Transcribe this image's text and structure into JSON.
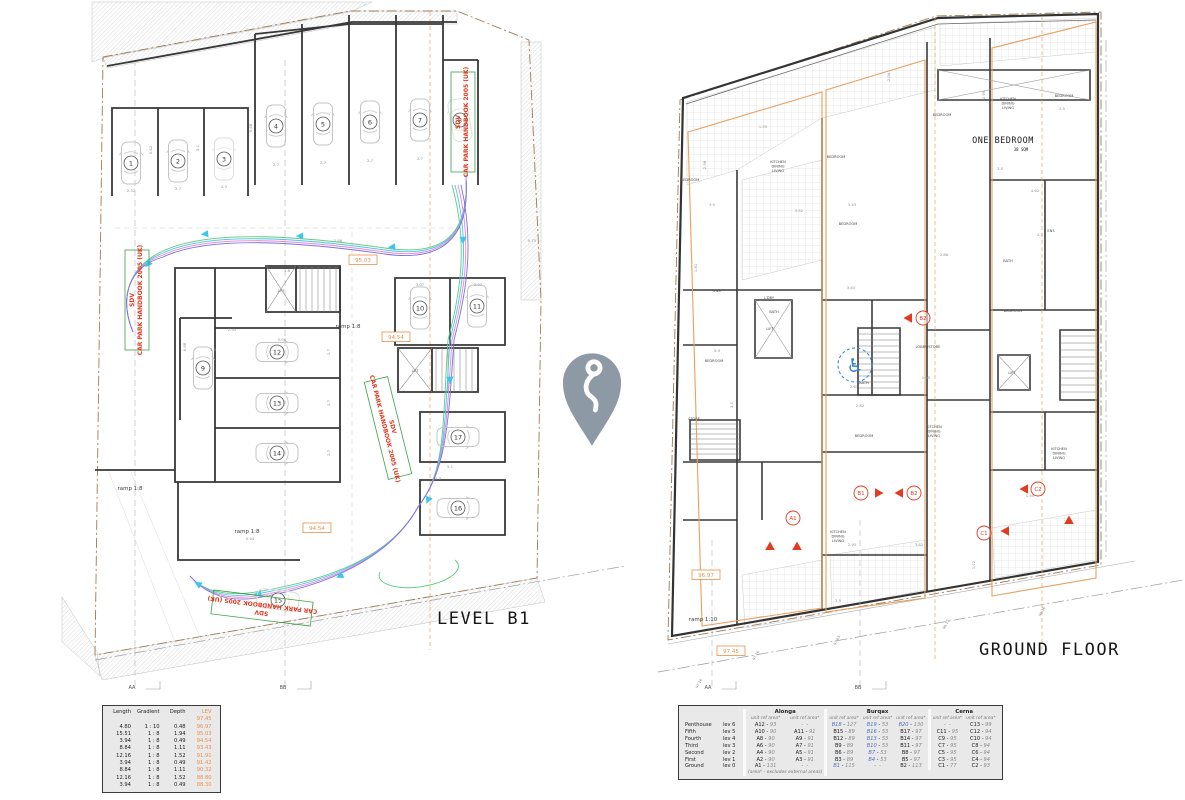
{
  "colors": {
    "red": "#e23b22",
    "orange": "#e8914c",
    "orange_line": "#e8a060",
    "boundary": "#9c7a55",
    "blue_ref": "#4a73c0",
    "wheelchair_blue": "#2b7fd4",
    "pin": "#8d9aa6",
    "swept": [
      "#62c97f",
      "#45c7e8",
      "#ee82d8",
      "#7a72e0"
    ],
    "arrow": "#3ec7ea",
    "green_box": "#3da04a"
  },
  "center_marker": {
    "icon": "location-pin"
  },
  "left_plan": {
    "title": "LEVEL B1",
    "section_markers": [
      {
        "label": "AA",
        "x": 132,
        "y": 689
      },
      {
        "label": "BB",
        "x": 283,
        "y": 689
      }
    ],
    "sdv_labels": [
      {
        "line1": "SDV",
        "line2": "CAR PARK HANDBOOK 2005 (UK)",
        "x": 463,
        "y": 122,
        "rot": -90
      },
      {
        "line1": "SDV",
        "line2": "CAR PARK HANDBOOK 2005 (UK)",
        "x": 137,
        "y": 300,
        "rot": -90
      },
      {
        "line1": "SDV",
        "line2": "CAR PARK HANDBOOK 2005 (UK)",
        "x": 388,
        "y": 428,
        "rot": 76
      },
      {
        "line1": "SDV",
        "line2": "CAR PARK HANDBOOK 2005 (UK)",
        "x": 262,
        "y": 608,
        "rot": 187
      }
    ],
    "ramp_labels": [
      {
        "text": "ramp 1:8",
        "x": 348,
        "y": 328
      },
      {
        "text": "ramp 1:8",
        "x": 247,
        "y": 533
      },
      {
        "text": "ramp 1:8",
        "x": 130,
        "y": 490
      }
    ],
    "spot_levels": [
      {
        "text": "95.03",
        "x": 363,
        "y": 262
      },
      {
        "text": "94.54",
        "x": 396,
        "y": 339
      },
      {
        "text": "94.54",
        "x": 317,
        "y": 530
      }
    ],
    "lift_label": "LIFT",
    "bays": [
      {
        "n": "1",
        "x": 131,
        "y": 163,
        "rot": 0
      },
      {
        "n": "2",
        "x": 178,
        "y": 161,
        "rot": 0
      },
      {
        "n": "3",
        "x": 224,
        "y": 159,
        "rot": 0,
        "faint": true
      },
      {
        "n": "4",
        "x": 276,
        "y": 126,
        "rot": 0
      },
      {
        "n": "5",
        "x": 323,
        "y": 124,
        "rot": 0
      },
      {
        "n": "6",
        "x": 370,
        "y": 122,
        "rot": 0
      },
      {
        "n": "7",
        "x": 420,
        "y": 120,
        "rot": 0
      },
      {
        "n": "8",
        "x": 460,
        "y": 120,
        "rot": -10,
        "faint": true
      },
      {
        "n": "9",
        "x": 203,
        "y": 368,
        "rot": 0
      },
      {
        "n": "10",
        "x": 420,
        "y": 308,
        "rot": 0
      },
      {
        "n": "11",
        "x": 477,
        "y": 306,
        "rot": 0
      },
      {
        "n": "12",
        "x": 277,
        "y": 352,
        "rot": 90
      },
      {
        "n": "13",
        "x": 277,
        "y": 403,
        "rot": 90
      },
      {
        "n": "14",
        "x": 277,
        "y": 453,
        "rot": 90
      },
      {
        "n": "15",
        "x": 278,
        "y": 600,
        "rot": 97,
        "faint": true
      },
      {
        "n": "16",
        "x": 458,
        "y": 508,
        "rot": 90
      },
      {
        "n": "17",
        "x": 458,
        "y": 437,
        "rot": 90
      }
    ],
    "dims": [
      {
        "t": "2.32",
        "x": 131,
        "y": 192
      },
      {
        "t": "2.7",
        "x": 178,
        "y": 190
      },
      {
        "t": "2.3",
        "x": 224,
        "y": 188
      },
      {
        "t": "2.7",
        "x": 276,
        "y": 166
      },
      {
        "t": "2.7",
        "x": 323,
        "y": 164
      },
      {
        "t": "2.7",
        "x": 370,
        "y": 162
      },
      {
        "t": "2.7",
        "x": 420,
        "y": 160
      },
      {
        "t": "5.42",
        "x": 152,
        "y": 150,
        "r": -90
      },
      {
        "t": "5.1",
        "x": 199,
        "y": 148,
        "r": -90
      },
      {
        "t": "5.68",
        "x": 252,
        "y": 128,
        "r": -90
      },
      {
        "t": "2.86",
        "x": 338,
        "y": 242
      },
      {
        "t": "2.93",
        "x": 232,
        "y": 331
      },
      {
        "t": "5.06",
        "x": 282,
        "y": 341
      },
      {
        "t": "6.88",
        "x": 186,
        "y": 347,
        "r": -90
      },
      {
        "t": "3.07",
        "x": 420,
        "y": 286
      },
      {
        "t": "3.07",
        "x": 478,
        "y": 286
      },
      {
        "t": "2.7",
        "x": 330,
        "y": 352,
        "r": -90
      },
      {
        "t": "2.7",
        "x": 330,
        "y": 403,
        "r": -90
      },
      {
        "t": "2.7",
        "x": 330,
        "y": 453,
        "r": -90
      },
      {
        "t": "5.3",
        "x": 438,
        "y": 480
      },
      {
        "t": "5.1",
        "x": 450,
        "y": 468
      },
      {
        "t": "1.6",
        "x": 287,
        "y": 272
      },
      {
        "t": "0.94",
        "x": 250,
        "y": 540
      },
      {
        "t": "5.9",
        "x": 213,
        "y": 351
      },
      {
        "t": "0.75",
        "x": 532,
        "y": 242
      }
    ]
  },
  "right_plan": {
    "title": "GROUND FLOOR",
    "section_markers": [
      {
        "label": "AA",
        "x": 708,
        "y": 689
      },
      {
        "label": "BB",
        "x": 858,
        "y": 689
      }
    ],
    "ramp_labels": [
      {
        "text": "ramp 1:10",
        "x": 703,
        "y": 621
      }
    ],
    "spot_levels": [
      {
        "text": "96.97",
        "x": 706,
        "y": 577
      },
      {
        "text": "97.45",
        "x": 731,
        "y": 653
      }
    ],
    "street_levels": [
      {
        "text": "97.16",
        "x": 700,
        "y": 684
      },
      {
        "text": "97.16",
        "x": 757,
        "y": 656
      },
      {
        "text": "97.63",
        "x": 838,
        "y": 641
      },
      {
        "text": "98.15",
        "x": 947,
        "y": 625
      },
      {
        "text": "98.36",
        "x": 1043,
        "y": 612
      }
    ],
    "one_bedroom": {
      "label": "ONE BEDROOM",
      "area": "38 SQM",
      "x": 1003,
      "y": 143
    },
    "unit_markers": [
      {
        "label": "A1",
        "x": 793,
        "y": 518
      },
      {
        "label": "B1",
        "x": 861,
        "y": 493
      },
      {
        "label": "B2",
        "x": 914,
        "y": 493
      },
      {
        "label": "B2",
        "x": 923,
        "y": 318
      },
      {
        "label": "C1",
        "x": 984,
        "y": 533
      },
      {
        "label": "C2",
        "x": 1038,
        "y": 489
      }
    ],
    "entry_arrows": [
      {
        "x": 770,
        "y": 546,
        "r": 0
      },
      {
        "x": 797,
        "y": 546,
        "r": 0
      },
      {
        "x": 879,
        "y": 493,
        "r": 90
      },
      {
        "x": 899,
        "y": 493,
        "r": -90
      },
      {
        "x": 908,
        "y": 318,
        "r": -90
      },
      {
        "x": 1005,
        "y": 531,
        "r": -90
      },
      {
        "x": 1024,
        "y": 489,
        "r": -90
      },
      {
        "x": 1069,
        "y": 520,
        "r": 0
      }
    ],
    "rooms": [
      {
        "t": "BEDROOM",
        "x": 690,
        "y": 181
      },
      {
        "t": "KITCHEN|DINING|LIVING",
        "x": 778,
        "y": 163
      },
      {
        "t": "BEDROOM",
        "x": 836,
        "y": 158
      },
      {
        "t": "BEDROOM",
        "x": 942,
        "y": 116
      },
      {
        "t": "KITCHEN|DINING|LIVING",
        "x": 1008,
        "y": 100
      },
      {
        "t": "BEDROOM",
        "x": 1064,
        "y": 97
      },
      {
        "t": "BEDROOM",
        "x": 848,
        "y": 225
      },
      {
        "t": "BEDROOM",
        "x": 1013,
        "y": 312
      },
      {
        "t": "BEDROOM",
        "x": 714,
        "y": 362
      },
      {
        "t": "BEDROOM",
        "x": 864,
        "y": 437
      },
      {
        "t": "LOBBY/STORE",
        "x": 928,
        "y": 348
      },
      {
        "t": "KITCHEN|DINING|LIVING",
        "x": 934,
        "y": 428
      },
      {
        "t": "LIFT",
        "x": 1012,
        "y": 374
      },
      {
        "t": "STORE",
        "x": 694,
        "y": 420
      },
      {
        "t": "BATH",
        "x": 774,
        "y": 313
      },
      {
        "t": "L'DRY",
        "x": 769,
        "y": 299
      },
      {
        "t": "ENS",
        "x": 717,
        "y": 292
      },
      {
        "t": "KITCHEN|DINING|LIVING",
        "x": 1059,
        "y": 450
      },
      {
        "t": "KITCHEN|DINING|LIVING",
        "x": 838,
        "y": 533
      },
      {
        "t": "BATH",
        "x": 1008,
        "y": 262
      },
      {
        "t": "BATH",
        "x": 864,
        "y": 384
      },
      {
        "t": "ENS",
        "x": 1051,
        "y": 232
      },
      {
        "t": "LIFT",
        "x": 770,
        "y": 330
      }
    ],
    "dims": [
      {
        "t": "3.5",
        "x": 712,
        "y": 206
      },
      {
        "t": "3.52",
        "x": 799,
        "y": 212
      },
      {
        "t": "3.43",
        "x": 851,
        "y": 289
      },
      {
        "t": "3.43",
        "x": 852,
        "y": 206
      },
      {
        "t": "2.86",
        "x": 944,
        "y": 256
      },
      {
        "t": "3.5",
        "x": 1000,
        "y": 170
      },
      {
        "t": "3.5",
        "x": 1062,
        "y": 110
      },
      {
        "t": "2.3",
        "x": 1040,
        "y": 236
      },
      {
        "t": "4.62",
        "x": 1035,
        "y": 192
      },
      {
        "t": "2.82",
        "x": 860,
        "y": 407
      },
      {
        "t": "2.67",
        "x": 854,
        "y": 388
      },
      {
        "t": "1.95",
        "x": 926,
        "y": 379
      },
      {
        "t": "3.82",
        "x": 919,
        "y": 546
      },
      {
        "t": "2.95",
        "x": 852,
        "y": 546
      },
      {
        "t": "1.55",
        "x": 1030,
        "y": 497
      },
      {
        "t": "2.95",
        "x": 985,
        "y": 95,
        "r": -90
      },
      {
        "t": "2.04",
        "x": 890,
        "y": 77,
        "r": -90
      },
      {
        "t": "1.81",
        "x": 697,
        "y": 268,
        "r": -90
      },
      {
        "t": "5.9",
        "x": 717,
        "y": 352
      },
      {
        "t": "3.1",
        "x": 733,
        "y": 405,
        "r": -90
      },
      {
        "t": "1.55",
        "x": 763,
        "y": 128
      },
      {
        "t": "2.98",
        "x": 706,
        "y": 165,
        "r": -90
      },
      {
        "t": "3.5",
        "x": 838,
        "y": 602
      },
      {
        "t": "1.72",
        "x": 975,
        "y": 565,
        "r": -90
      }
    ],
    "accessible_icon": "wheelchair-symbol"
  },
  "ramp_table": {
    "headers": [
      "Length",
      "Gradient",
      "Depth",
      "LEV"
    ],
    "rows": [
      [
        "",
        "",
        "",
        "97.45"
      ],
      [
        "4.80",
        "1 : 10",
        "0.48",
        "96.97"
      ],
      [
        "15.51",
        "1 : 8",
        "1.94",
        "95.03"
      ],
      [
        "3.94",
        "1 : 8",
        "0.49",
        "94.54"
      ],
      [
        "8.84",
        "1 : 8",
        "1.11",
        "93.43"
      ],
      [
        "12.16",
        "1 : 8",
        "1.52",
        "91.91"
      ],
      [
        "3.94",
        "1 : 8",
        "0.49",
        "91.42"
      ],
      [
        "8.84",
        "1 : 8",
        "1.11",
        "90.32"
      ],
      [
        "12.16",
        "1 : 8",
        "1.52",
        "88.80"
      ],
      [
        "3.94",
        "1 : 8",
        "0.49",
        "88.30"
      ]
    ]
  },
  "unit_table": {
    "groups": [
      {
        "name": "Alonga",
        "cols": 2
      },
      {
        "name": "Burqax",
        "cols": 3
      },
      {
        "name": "Cerna",
        "cols": 2
      }
    ],
    "sub_header": "unit ref    area*",
    "blue_refs": [
      "B1",
      "B4",
      "B7",
      "B10",
      "B13",
      "B16",
      "B18",
      "B19",
      "B20"
    ],
    "rows": [
      {
        "floor": "Penthouse",
        "lev": "lev 6",
        "cells": [
          [
            "A12",
            "93"
          ],
          null,
          [
            "B18",
            "127"
          ],
          [
            "B19",
            "53"
          ],
          [
            "B20",
            "130"
          ],
          null,
          [
            "C13",
            "99"
          ]
        ]
      },
      {
        "floor": "Fifth",
        "lev": "lev 5",
        "cells": [
          [
            "A10",
            "90"
          ],
          [
            "A11",
            "91"
          ],
          [
            "B15",
            "89"
          ],
          [
            "B16",
            "53"
          ],
          [
            "B17",
            "97"
          ],
          [
            "C11",
            "95"
          ],
          [
            "C12",
            "94"
          ]
        ]
      },
      {
        "floor": "Fourth",
        "lev": "lev 4",
        "cells": [
          [
            "A8",
            "90"
          ],
          [
            "A9",
            "91"
          ],
          [
            "B12",
            "89"
          ],
          [
            "B13",
            "53"
          ],
          [
            "B14",
            "97"
          ],
          [
            "C9",
            "95"
          ],
          [
            "C10",
            "94"
          ]
        ]
      },
      {
        "floor": "Third",
        "lev": "lev 3",
        "cells": [
          [
            "A6",
            "90"
          ],
          [
            "A7",
            "91"
          ],
          [
            "B9",
            "89"
          ],
          [
            "B10",
            "53"
          ],
          [
            "B11",
            "97"
          ],
          [
            "C7",
            "95"
          ],
          [
            "C8",
            "94"
          ]
        ]
      },
      {
        "floor": "Second",
        "lev": "lev 2",
        "cells": [
          [
            "A4",
            "90"
          ],
          [
            "A5",
            "91"
          ],
          [
            "B6",
            "89"
          ],
          [
            "B7",
            "53"
          ],
          [
            "B8",
            "97"
          ],
          [
            "C5",
            "95"
          ],
          [
            "C6",
            "94"
          ]
        ]
      },
      {
        "floor": "First",
        "lev": "lev 1",
        "cells": [
          [
            "A2",
            "90"
          ],
          [
            "A3",
            "91"
          ],
          [
            "B3",
            "89"
          ],
          [
            "B4",
            "53"
          ],
          [
            "B5",
            "97"
          ],
          [
            "C3",
            "95"
          ],
          [
            "C4",
            "94"
          ]
        ]
      },
      {
        "floor": "Ground",
        "lev": "lev 0",
        "cells": [
          [
            "A1",
            "131"
          ],
          null,
          [
            "B1",
            "115"
          ],
          null,
          [
            "B2",
            "113"
          ],
          [
            "C1",
            "77"
          ],
          [
            "C2",
            "93"
          ]
        ]
      }
    ],
    "footnote": "(area* - excludes external areas)"
  }
}
